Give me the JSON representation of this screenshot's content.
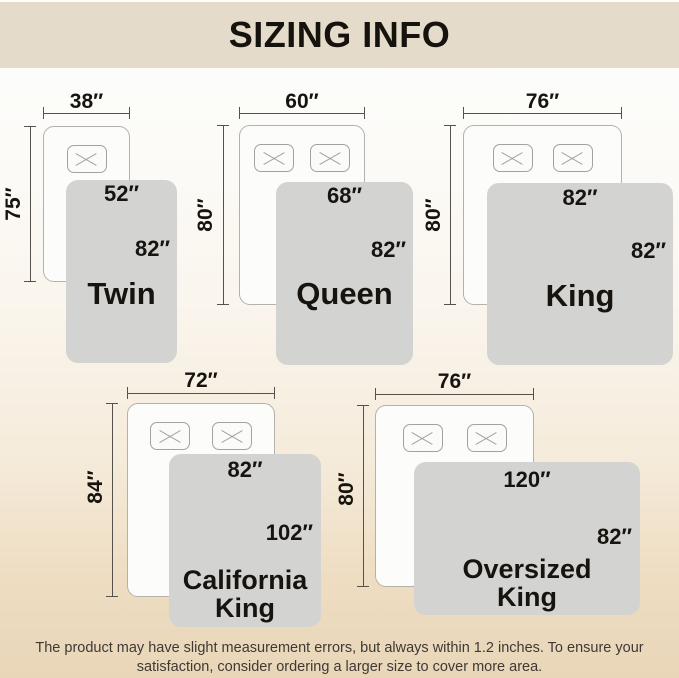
{
  "header": {
    "title": "SIZING INFO"
  },
  "sizes": [
    {
      "name": "Twin",
      "bed_width": "38″",
      "bed_length": "75″",
      "blanket_width": "52″",
      "blanket_length": "82″"
    },
    {
      "name": "Queen",
      "bed_width": "60″",
      "bed_length": "80″",
      "blanket_width": "68″",
      "blanket_length": "82″"
    },
    {
      "name": "King",
      "bed_width": "76″",
      "bed_length": "80″",
      "blanket_width": "82″",
      "blanket_length": "82″"
    },
    {
      "name": "California King",
      "bed_width": "72″",
      "bed_length": "84″",
      "blanket_width": "82″",
      "blanket_length": "102″"
    },
    {
      "name": "Oversized King",
      "bed_width": "76″",
      "bed_length": "80″",
      "blanket_width": "120″",
      "blanket_length": "82″"
    }
  ],
  "footer": {
    "text": "The product may have slight measurement errors, but always within 1.2 inches. To ensure your satisfaction, consider ordering a larger size to cover more area."
  },
  "colors": {
    "header_band": "#e4dbca",
    "blanket_gray": "#d3d3d2",
    "bed_border": "#b4b1ac",
    "dim_line": "#55524d",
    "page_bottom": "#e9d6b9"
  }
}
